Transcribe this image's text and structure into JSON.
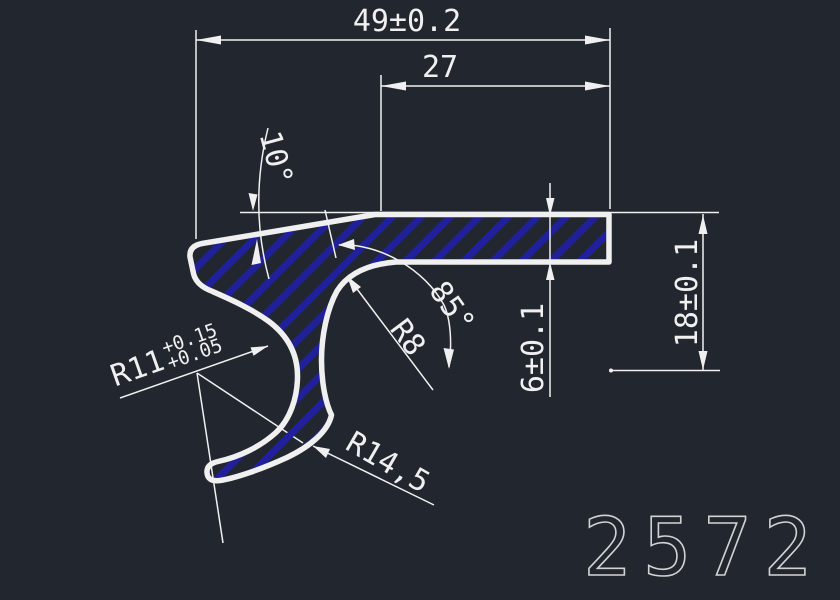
{
  "drawing": {
    "type": "cad-profile-cross-section",
    "part_number": "2572",
    "colors": {
      "bg": "#22262e",
      "line": "#f0f0f0",
      "hatch": "#20209a",
      "title": "#d2d2d2"
    },
    "dimensions": {
      "overall_width": "49±0.2",
      "plate_width": "27",
      "top_angle": "10°",
      "stem_angle": "85°",
      "fillet_radius": "R8",
      "plate_thickness": "6±0.1",
      "overall_height": "18±0.1",
      "inner_radius": "R11",
      "inner_radius_tol_upper": "+0.15",
      "inner_radius_tol_lower": "+0.05",
      "outer_radius": "R14,5"
    }
  }
}
